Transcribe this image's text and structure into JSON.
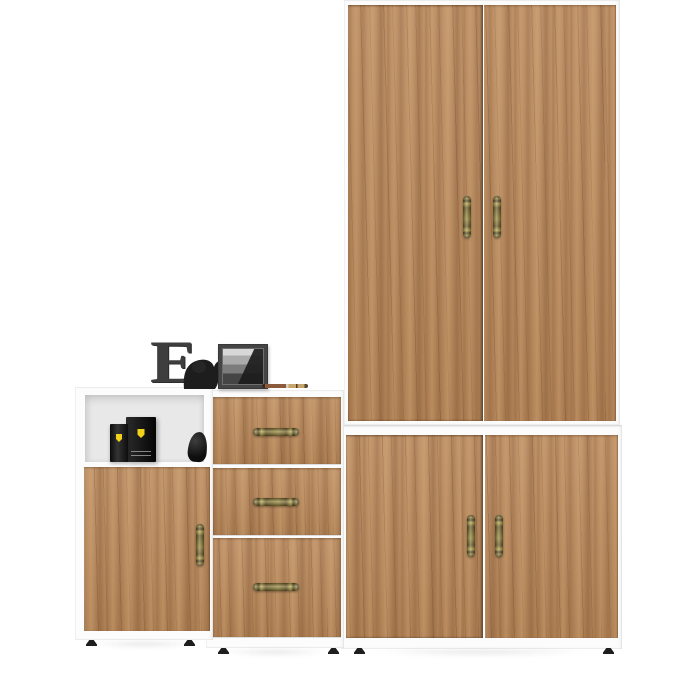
{
  "canvas": {
    "width": 700,
    "height": 676,
    "background": "#ffffff"
  },
  "colors": {
    "wood_base": "#b9885a",
    "wood_light": "#d2a474",
    "wood_dark": "#8a5f38",
    "wood_seam": "#5f4426",
    "carcass_white": "#fcfcfc",
    "carcass_shade": "#e9e9e9",
    "niche_back": "#e8e8e8",
    "brass_mid": "#8a7a33",
    "brass_dark": "#4f4520",
    "brass_light": "#c2ae52",
    "decor_dark": "#3e3e3e",
    "frame_outer": "#454545",
    "ferrari_yellow": "#f2d11b",
    "foot_dark": "#1e1e1e"
  },
  "furniture": {
    "wardrobe": {
      "kind": "tall-two-door-wardrobe",
      "door_count": 2,
      "handle_style": "vertical-antique-brass"
    },
    "lower_cabinet": {
      "kind": "two-door-base-cabinet",
      "door_count": 2,
      "handle_style": "vertical-antique-brass"
    },
    "drawer_chest": {
      "kind": "three-drawer-chest",
      "drawer_count": 3,
      "handle_style": "horizontal-antique-brass"
    },
    "shelf_cabinet": {
      "kind": "single-door-cabinet-with-open-shelf",
      "door_count": 1,
      "handle_style": "vertical-antique-brass"
    }
  },
  "decor": {
    "letter": "E",
    "shelf_items": [
      "perfume-bottle",
      "perfume-box",
      "bird-figurine"
    ],
    "top_items": [
      "decorative-letter",
      "elephant-figurine",
      "photo-frame",
      "pencil"
    ]
  }
}
